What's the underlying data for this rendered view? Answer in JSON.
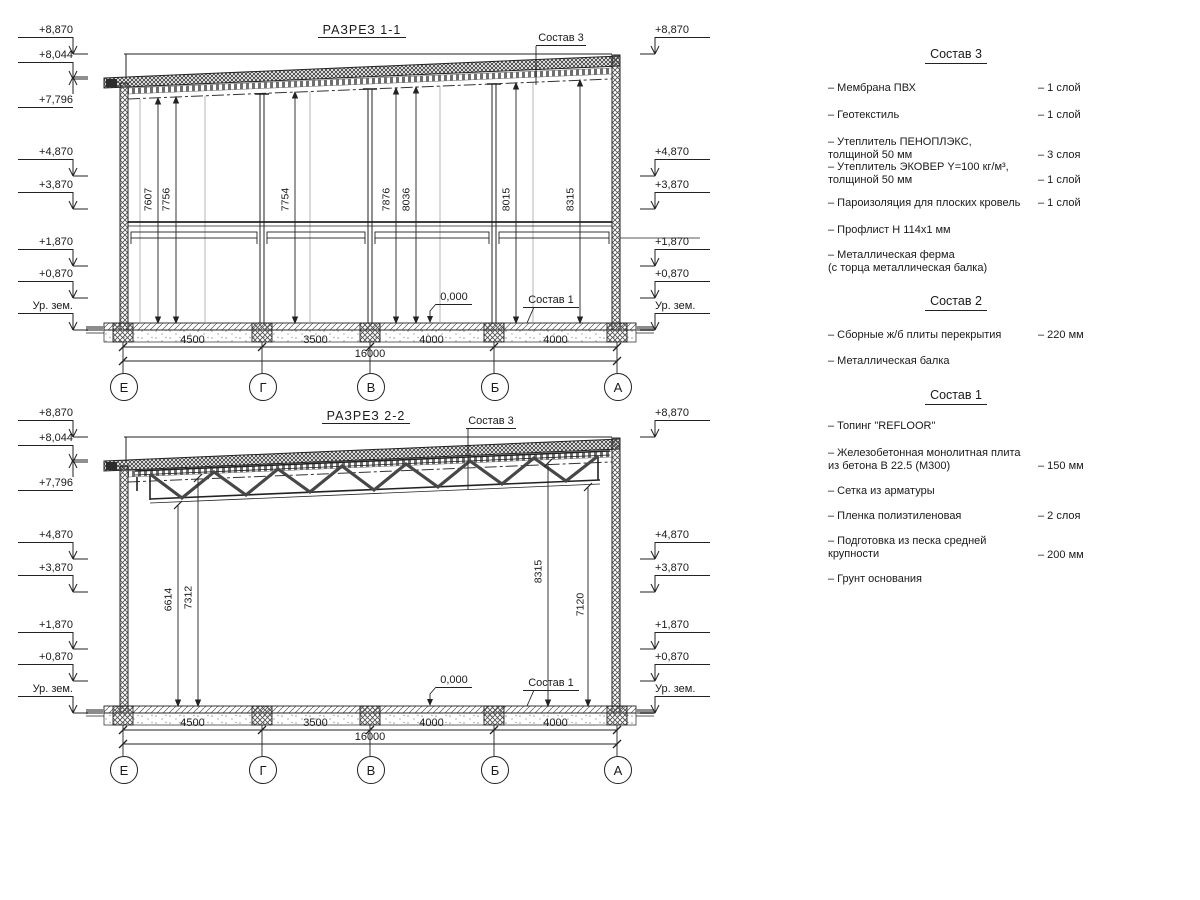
{
  "common": {
    "elev": {
      "e887": "+8,870",
      "e804": "+8,044",
      "e779": "+7,796",
      "e487": "+4,870",
      "e387": "+3,870",
      "e187": "+1,870",
      "e087": "+0,870",
      "ground": "Ур. зем."
    },
    "dims": [
      "4500",
      "3500",
      "4000",
      "4000"
    ],
    "total": "16000",
    "axes": [
      "Е",
      "Г",
      "В",
      "Б",
      "А"
    ],
    "zero": "0,000",
    "sostav3_label": "Состав 3",
    "sostav1_label": "Состав 1"
  },
  "s1": {
    "title": "РАЗРЕЗ 1-1",
    "heights": [
      "7607",
      "7756",
      "7754",
      "7876",
      "8036",
      "8015",
      "8315"
    ]
  },
  "s2": {
    "title": "РАЗРЕЗ 2-2",
    "heights": [
      "6614",
      "7312",
      "8315",
      "7120"
    ]
  },
  "legend": {
    "s3": {
      "title": "Состав 3",
      "items": [
        {
          "name": "– Мембрана ПВХ",
          "value": "– 1 слой"
        },
        {
          "name": "– Геотекстиль",
          "value": "– 1 слой"
        },
        {
          "name": "– Утеплитель ПЕНОПЛЭКС,\nтолщиной 50 мм",
          "value": "– 3 слоя"
        },
        {
          "name": "– Утеплитель ЭКОВЕР Y=100 кг/м³,\nтолщиной 50 мм",
          "value": "– 1 слой"
        },
        {
          "name": "– Пароизоляция для плоских кровель",
          "value": "– 1 слой"
        },
        {
          "name": "– Профлист Н 114х1 мм",
          "value": ""
        },
        {
          "name": "– Металлическая ферма\n(с торца металлическая балка)",
          "value": ""
        }
      ]
    },
    "s2": {
      "title": "Состав 2",
      "items": [
        {
          "name": "– Сборные ж/б плиты перекрытия",
          "value": "– 220 мм"
        },
        {
          "name": "– Металлическая балка",
          "value": ""
        }
      ]
    },
    "s1": {
      "title": "Состав 1",
      "items": [
        {
          "name": "– Топинг \"REFLOOR\"",
          "value": ""
        },
        {
          "name": "– Железобетонная  монолитная плита\nиз бетона В 22.5 (М300)",
          "value": "– 150 мм"
        },
        {
          "name": "– Сетка из арматуры",
          "value": ""
        },
        {
          "name": "– Пленка полиэтиленовая",
          "value": "– 2 слоя"
        },
        {
          "name": "– Подготовка из песка средней\nкрупности",
          "value": "– 200 мм"
        },
        {
          "name": "– Грунт основания",
          "value": ""
        }
      ]
    }
  }
}
